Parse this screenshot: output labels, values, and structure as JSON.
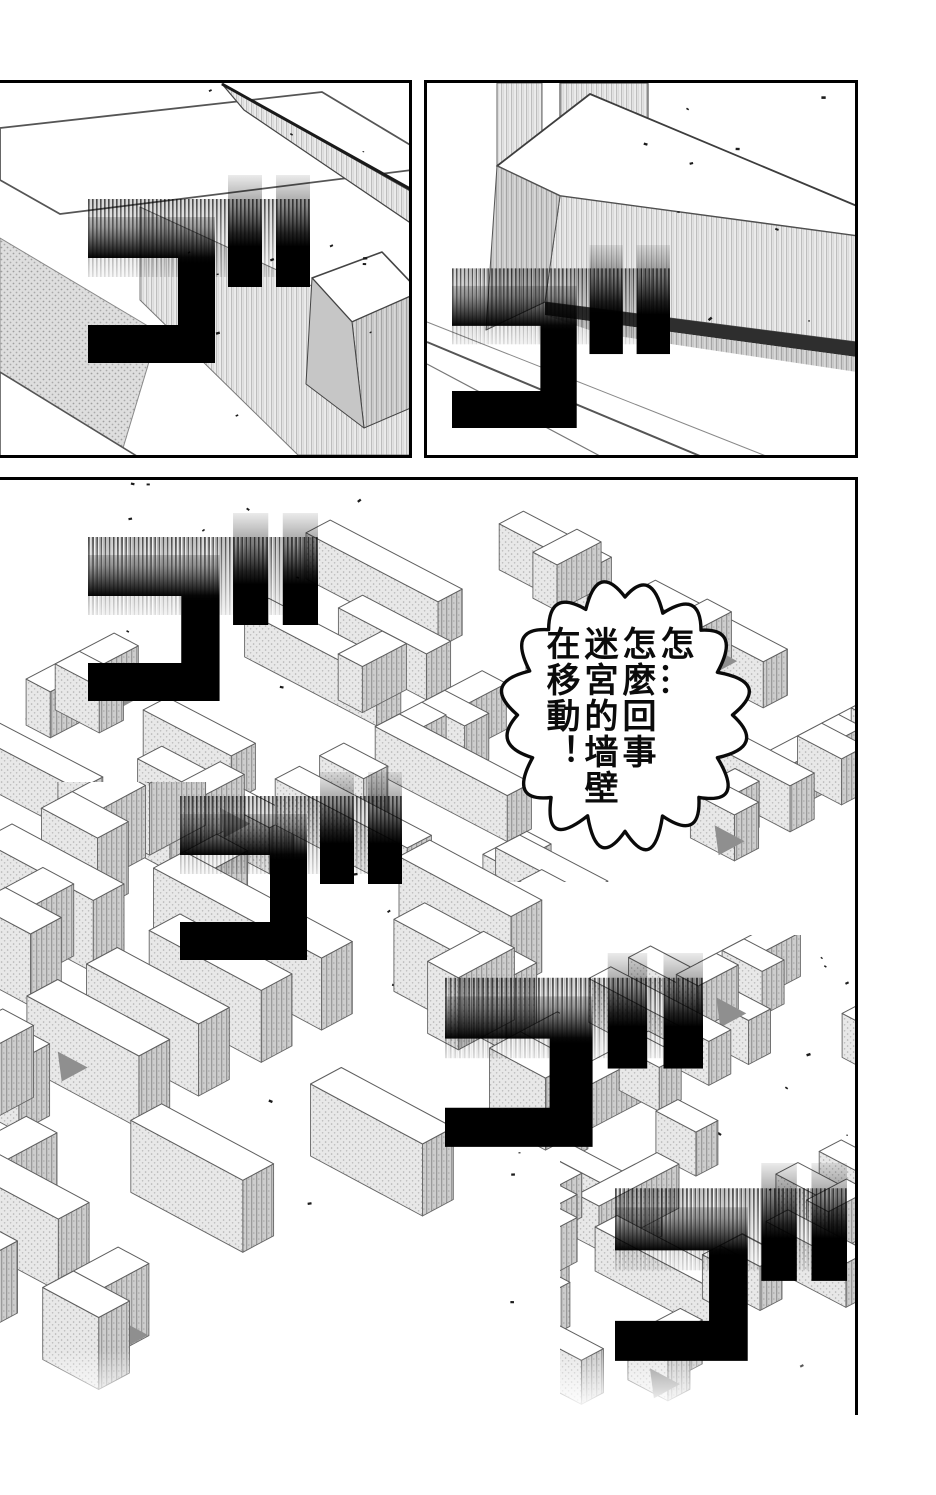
{
  "page": {
    "type": "manga-page",
    "paper": "#ffffff",
    "ink": "#000000"
  },
  "bubble": {
    "lines": [
      "怎…",
      "怎麼回事",
      "迷宮的墙壁",
      "在移動！"
    ]
  },
  "sfx": {
    "glyph": "ゴ",
    "meaning": "rumble-sound-effect",
    "count": 6
  },
  "colors": {
    "wall_light": "#e8e8e8",
    "wall_mid": "#cdcdcd",
    "wall_dark": "#909090",
    "line": "#555555"
  }
}
